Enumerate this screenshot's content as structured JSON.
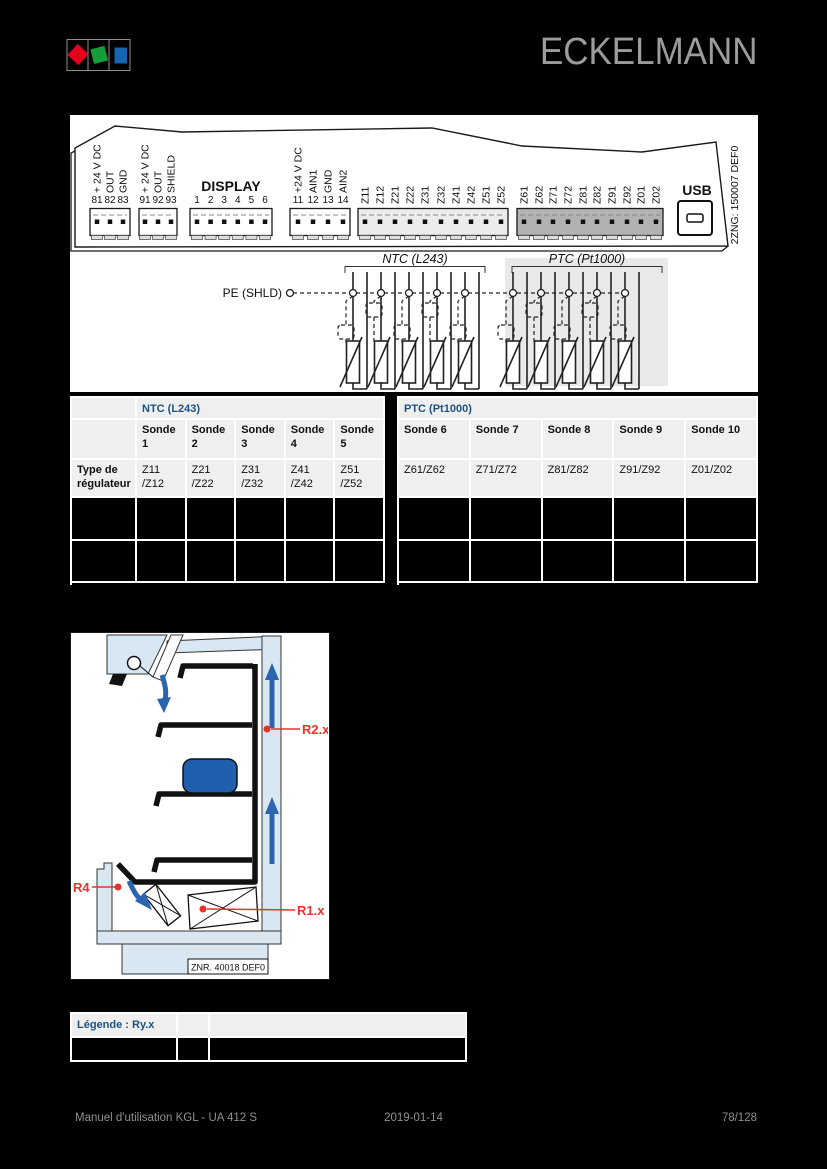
{
  "page": {
    "background": "#000000"
  },
  "header": {
    "brand": "ECKELMANN",
    "logo": {
      "red": "#e2001a",
      "green": "#169c38",
      "blue": "#1565b0"
    }
  },
  "device": {
    "display_label": "DISPLAY",
    "usb_label": "USB",
    "side_label": "2ZNG: 150007 DEF0",
    "blocks": [
      {
        "id": "power-out-1",
        "pins": [
          "81",
          "82",
          "83"
        ],
        "labels": [
          "+ 24 V DC",
          "OUT",
          "GND"
        ]
      },
      {
        "id": "power-out-2",
        "pins": [
          "91",
          "92",
          "93"
        ],
        "labels": [
          "+ 24 V DC",
          "OUT",
          "SHIELD"
        ]
      },
      {
        "id": "display",
        "pins": [
          "1",
          "2",
          "3",
          "4",
          "5",
          "6"
        ],
        "labels": []
      },
      {
        "id": "analog-in",
        "pins": [
          "11",
          "12",
          "13",
          "14"
        ],
        "labels": [
          "+24 V DC",
          "AIN1",
          "GND",
          "AIN2"
        ]
      },
      {
        "id": "ntc-terminals",
        "pins": [],
        "labels": [
          "Z11",
          "Z12",
          "Z21",
          "Z22",
          "Z31",
          "Z32",
          "Z41",
          "Z42",
          "Z51",
          "Z52"
        ]
      },
      {
        "id": "ptc-terminals",
        "pins": [],
        "labels": [
          "Z61",
          "Z62",
          "Z71",
          "Z72",
          "Z81",
          "Z82",
          "Z91",
          "Z92",
          "Z01",
          "Z02"
        ]
      }
    ]
  },
  "sensors": {
    "pe_label": "PE (SHLD)",
    "ntc_group": "NTC (L243)",
    "ptc_group": "PTC (Pt1000)",
    "ntc_count": 5,
    "ptc_count": 5
  },
  "table": {
    "row_label": "Type de régulateur",
    "header_color": "#1c5282",
    "blank_rows": 2,
    "sections": [
      {
        "header": "NTC (L243)",
        "columns": [
          "Sonde 1",
          "Sonde 2",
          "Sonde 3",
          "Sonde 4",
          "Sonde 5"
        ],
        "terminals": [
          "Z11\n/Z12",
          "Z21\n/Z22",
          "Z31\n/Z32",
          "Z41\n/Z42",
          "Z51\n/Z52"
        ]
      },
      {
        "header": "PTC (Pt1000)",
        "columns": [
          "Sonde 6",
          "Sonde 7",
          "Sonde 8",
          "Sonde 9",
          "Sonde 10"
        ],
        "terminals": [
          "Z61/Z62",
          "Z71/Z72",
          "Z81/Z82",
          "Z91/Z92",
          "Z01/Z02"
        ]
      }
    ]
  },
  "diagram": {
    "r2": "R2.x",
    "r4": "R4",
    "r1": "R1.x",
    "znr": "ZNR. 40018 DEF0",
    "colors": {
      "structure_fill": "#d9e7f3",
      "product": "#1f5fad",
      "airflow": "#2b65b0",
      "annotation": "#e5332a"
    }
  },
  "legend": {
    "title": "Légende : Ry.x"
  },
  "footer": {
    "left": "Manuel d'utilisation KGL - UA 412 S",
    "center": "2019-01-14",
    "right": "78/128"
  }
}
